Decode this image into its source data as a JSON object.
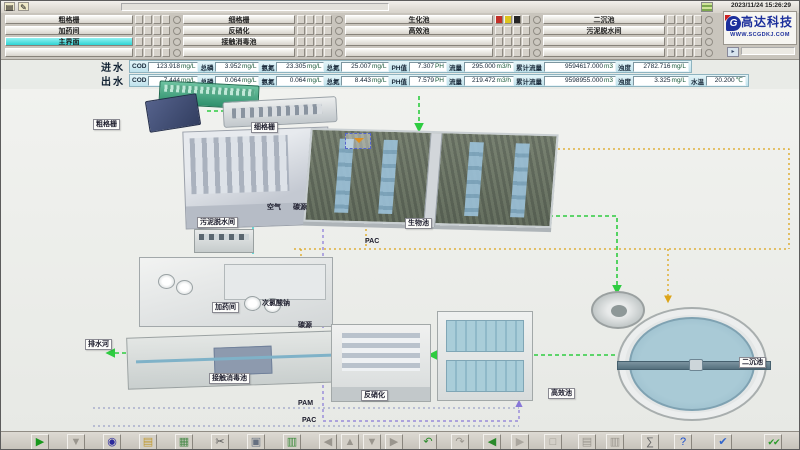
{
  "window": {
    "datetime": "2023/11/24 15:26:29"
  },
  "titlebar": {
    "icons": [
      {
        "name": "note-icon",
        "glyph": "▤"
      },
      {
        "name": "draw-icon",
        "glyph": "✎"
      }
    ]
  },
  "logo": {
    "company": "高达科技",
    "mark": "G",
    "website": "WWW.SCGDKJ.COM"
  },
  "menu": {
    "columns": [
      {
        "buttons": [
          {
            "label": "粗格栅",
            "active": false
          },
          {
            "label": "加药间",
            "active": false
          },
          {
            "label": "主界面",
            "active": true
          },
          {
            "label": "",
            "active": false
          }
        ]
      },
      {
        "buttons": [
          {
            "label": "细格栅",
            "active": false
          },
          {
            "label": "反硝化",
            "active": false
          },
          {
            "label": "接触消毒池",
            "active": false
          },
          {
            "label": "",
            "active": false
          }
        ]
      },
      {
        "buttons": [
          {
            "label": "生化池",
            "active": false
          },
          {
            "label": "高效池",
            "active": false
          },
          {
            "label": "",
            "active": false
          },
          {
            "label": "",
            "active": false
          }
        ]
      },
      {
        "buttons": [
          {
            "label": "二沉池",
            "active": false
          },
          {
            "label": "污泥脱水间",
            "active": false
          },
          {
            "label": "",
            "active": false
          },
          {
            "label": "",
            "active": false
          }
        ]
      }
    ],
    "alarm_buttons": [
      {
        "name": "alarm-red-button",
        "color": "#c23028"
      },
      {
        "name": "alarm-yellow-button",
        "color": "#ddc41e"
      },
      {
        "name": "alarm-black-button",
        "color": "#262626"
      }
    ]
  },
  "water_quality": {
    "rows": [
      {
        "name": "进水",
        "fields": [
          {
            "label": "COD",
            "value": "123.918",
            "unit": "mg/L"
          },
          {
            "label": "总磷",
            "value": "3.952",
            "unit": "mg/L"
          },
          {
            "label": "氨氮",
            "value": "23.305",
            "unit": "mg/L"
          },
          {
            "label": "总氮",
            "value": "25.007",
            "unit": "mg/L"
          },
          {
            "label": "PH值",
            "value": "7.307",
            "unit": "PH"
          },
          {
            "label": "流量",
            "value": "295.000",
            "unit": "m3/h"
          },
          {
            "label": "累计流量",
            "value": "9594617.000",
            "unit": "m3"
          },
          {
            "label": "浊度",
            "value": "2782.716",
            "unit": "mg/L"
          }
        ]
      },
      {
        "name": "出水",
        "fields": [
          {
            "label": "COD",
            "value": "7.444",
            "unit": "mg/L"
          },
          {
            "label": "总磷",
            "value": "0.064",
            "unit": "mg/L"
          },
          {
            "label": "氨氮",
            "value": "0.064",
            "unit": "mg/L"
          },
          {
            "label": "总氮",
            "value": "8.443",
            "unit": "mg/L"
          },
          {
            "label": "PH值",
            "value": "7.579",
            "unit": "PH"
          },
          {
            "label": "流量",
            "value": "219.472",
            "unit": "m3/h"
          },
          {
            "label": "累计流量",
            "value": "9598955.000",
            "unit": "m3"
          },
          {
            "label": "浊度",
            "value": "3.325",
            "unit": "mg/L"
          },
          {
            "label": "水温",
            "value": "20.200",
            "unit": "℃"
          }
        ]
      }
    ]
  },
  "diagram": {
    "labels": {
      "coarse_screen": "粗格栅",
      "fine_screen": "细格栅",
      "sludge_dewatering": "污泥脱水间",
      "bio_tank": "生物池",
      "air": "空气",
      "carbon_source_a": "碳源",
      "pac_a": "PAC",
      "dosing_room": "加药间",
      "sodium_hypochlorite": "次氯酸钠",
      "carbon_source_b": "碳源",
      "contact_tank": "接触消毒池",
      "denitrification": "反硝化",
      "high_efficiency": "高效池",
      "secondary_clarifier": "二沉池",
      "outfall_river": "排水河",
      "pam": "PAM",
      "pac_b": "PAC"
    },
    "flow_colors": {
      "water": "#2ecc40",
      "air": "#2ad0d0",
      "pac": "#8878d8",
      "carbon": "#dca418",
      "dosing": "#8890c0"
    }
  },
  "toolbar": {
    "icons": [
      {
        "name": "run-icon",
        "glyph": "▶",
        "color": "#18981c"
      },
      {
        "name": "filter-icon",
        "glyph": "▼",
        "color": "#9a968e"
      },
      {
        "name": "paint-icon",
        "glyph": "◉",
        "color": "#2c2a9c"
      },
      {
        "name": "open-icon",
        "glyph": "▤",
        "color": "#c09a30"
      },
      {
        "name": "image-icon",
        "glyph": "▦",
        "color": "#4a8a4a"
      },
      {
        "name": "cut-icon",
        "glyph": "✂",
        "color": "#555555"
      },
      {
        "name": "copy-icon",
        "glyph": "▣",
        "color": "#667080"
      },
      {
        "name": "paste-icon",
        "glyph": "▥",
        "color": "#3a8a3a"
      },
      {
        "name": "nav-left-icon",
        "glyph": "◀",
        "color": "#9a968e"
      },
      {
        "name": "nav-up-icon",
        "glyph": "▲",
        "color": "#9a968e"
      },
      {
        "name": "nav-down-icon",
        "glyph": "▼",
        "color": "#9a968e"
      },
      {
        "name": "nav-right-icon",
        "glyph": "▶",
        "color": "#9a968e"
      },
      {
        "name": "undo-icon",
        "glyph": "↶",
        "color": "#2a8a2a"
      },
      {
        "name": "redo-icon",
        "glyph": "↷",
        "color": "#9a968e"
      },
      {
        "name": "back-icon",
        "glyph": "◀",
        "color": "#2a8a2a"
      },
      {
        "name": "forward-icon",
        "glyph": "▶",
        "color": "#aaa69e"
      },
      {
        "name": "cascade-icon",
        "glyph": "□",
        "color": "#9a968e"
      },
      {
        "name": "tile-h-icon",
        "glyph": "▤",
        "color": "#9a968e"
      },
      {
        "name": "tile-v-icon",
        "glyph": "▥",
        "color": "#9a968e"
      },
      {
        "name": "sum-icon",
        "glyph": "∑",
        "color": "#666666"
      },
      {
        "name": "help-icon",
        "glyph": "?",
        "color": "#1a4ecc"
      },
      {
        "name": "audio-check-icon",
        "glyph": "✔",
        "color": "#3366cc"
      },
      {
        "name": "confirm-icon",
        "glyph": "✔✔",
        "color": "#2a9a2a"
      }
    ]
  }
}
